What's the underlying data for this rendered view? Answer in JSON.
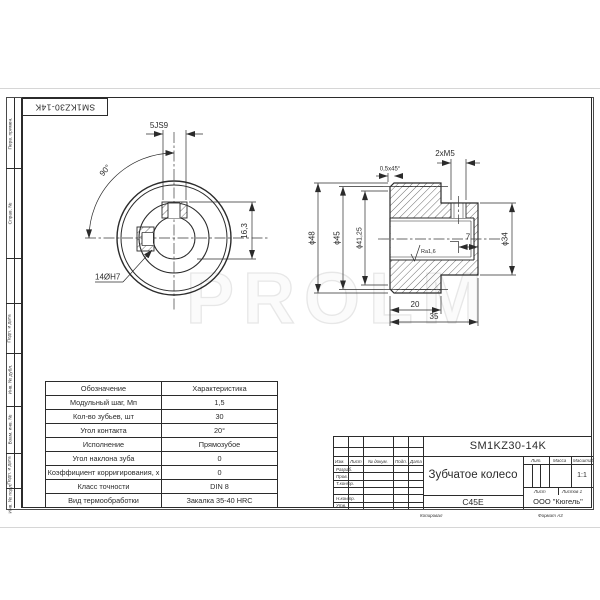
{
  "drawing": {
    "watermark": "PROLM",
    "top_stamp": "SM1KZ30-14K",
    "footer": {
      "copied": "Копировал",
      "format": "Формат   А3"
    }
  },
  "margin": {
    "top_strips": [
      {
        "label": "Перв. примен."
      },
      {
        "label": "Справ. №"
      }
    ],
    "bottom_strips": [
      {
        "label": "Подп. и дата"
      },
      {
        "label": "Инв. № дубл."
      },
      {
        "label": "Взам. инв. №"
      },
      {
        "label": "Подп. и дата"
      },
      {
        "label": "Инв. № подл."
      }
    ]
  },
  "front_view": {
    "dim_keyway_width": "5JS9",
    "dim_angle": "90°",
    "dim_keyway_depth": "16,3",
    "dim_bore": "14ØH7"
  },
  "section_view": {
    "dim_thread": "2xM5",
    "dim_chamfer": "0,5x45°",
    "dim_d48": "ϕ48",
    "dim_d45": "ϕ45",
    "dim_d4125": "ϕ41,25",
    "dim_d34": "ϕ34",
    "dim_7": "7",
    "dim_20": "20",
    "dim_35": "35",
    "roughness": "Ra1,6"
  },
  "params_table": {
    "headers": [
      "Обозначение",
      "Характеристика"
    ],
    "rows": [
      [
        "Модульный шаг, Мп",
        "1,5"
      ],
      [
        "Кол-во зубьев, шт",
        "30"
      ],
      [
        "Угол контакта",
        "20°"
      ],
      [
        "Исполнение",
        "Прямозубое"
      ],
      [
        "Угол наклона зуба",
        "0"
      ],
      [
        "Коэффициент корригирования, х",
        "0"
      ],
      [
        "Класс точности",
        "DIN 8"
      ],
      [
        "Вид термообработки",
        "Закалка 35-40 HRC"
      ]
    ]
  },
  "title_block": {
    "designation": "SM1KZ30-14K",
    "name": "Зубчатое колесо",
    "material": "C45E",
    "company": "ООО \"Кюгель\"",
    "scale_value": "1:1",
    "headers": {
      "lit": "Лит.",
      "mass": "Масса",
      "scale": "Масштаб",
      "sheet": "Лист",
      "sheets": "Листов   1"
    },
    "sign_cols": [
      "Изм.",
      "Лист",
      "№ докум.",
      "Подп.",
      "Дата"
    ],
    "sign_rows": [
      "Разраб.",
      "Пров.",
      "Т.контр.",
      "Н.контр.",
      "Утв."
    ]
  }
}
